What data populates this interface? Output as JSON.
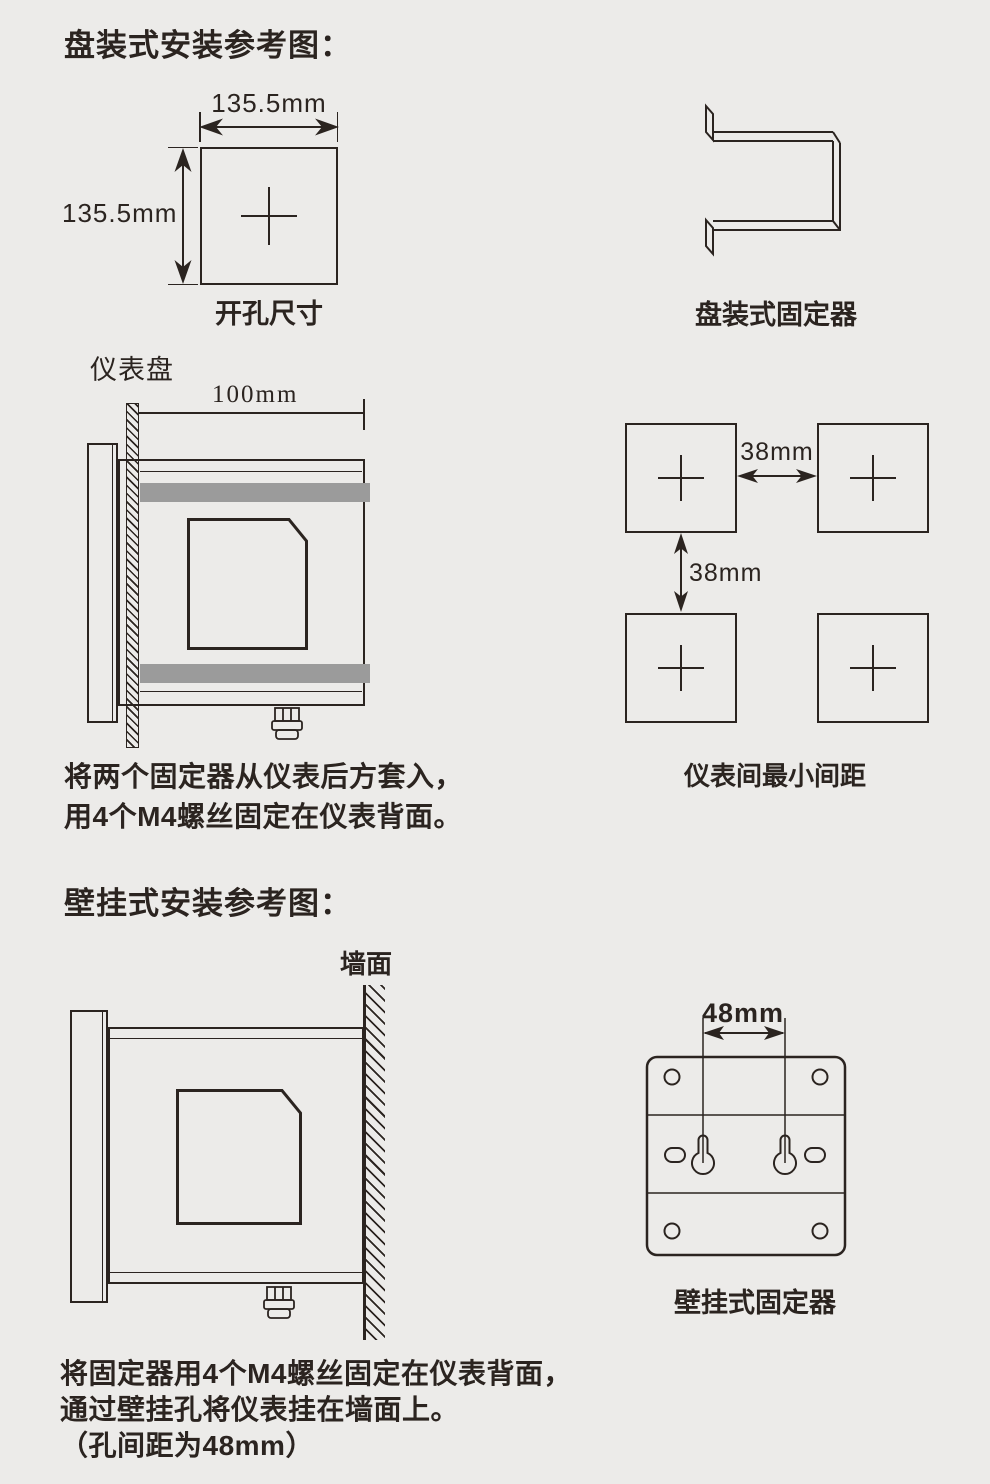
{
  "colors": {
    "background": "#ecebe9",
    "ink": "#2b2420",
    "fixer_bar_gray": "#9b9b9b"
  },
  "panel_section": {
    "title": "盘装式安装参考图：",
    "cutout": {
      "width_label": "135.5mm",
      "height_label": "135.5mm",
      "caption": "开孔尺寸"
    },
    "bracket": {
      "caption": "盘装式固定器"
    },
    "side_view": {
      "panel_label": "仪表盘",
      "depth_label": "100mm"
    },
    "spacing": {
      "horizontal_gap_label": "38mm",
      "vertical_gap_label": "38mm",
      "caption": "仪表间最小间距"
    },
    "note": {
      "line1": "将两个固定器从仪表后方套入，",
      "line2": "用4个M4螺丝固定在仪表背面。"
    }
  },
  "wall_section": {
    "title": "壁挂式安装参考图：",
    "side_view": {
      "wall_label": "墙面"
    },
    "fixer": {
      "hole_pitch_label": "48mm",
      "caption": "壁挂式固定器"
    },
    "note": {
      "line1": "将固定器用4个M4螺丝固定在仪表背面，",
      "line2": "通过壁挂孔将仪表挂在墙面上。",
      "line3": "（孔间距为48mm）"
    }
  }
}
